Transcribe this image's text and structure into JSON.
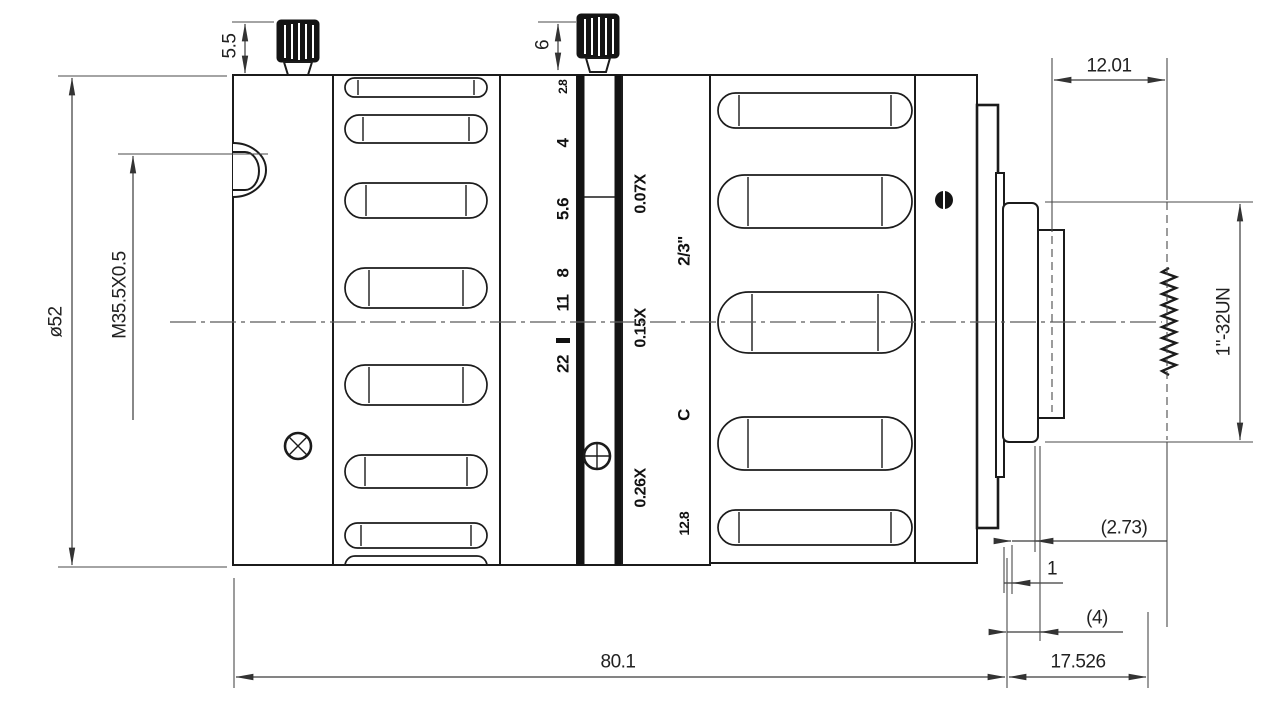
{
  "drawing": {
    "type": "lens-engineering-drawing",
    "dimensions": {
      "front_diameter": "ø52",
      "filter_thread": "M35.5X0.5",
      "front_knob_height": "5.5",
      "rear_knob_height": "6",
      "mount_section_length": "12.01",
      "mount_thread": "1\"-32UN",
      "flange_offset_ref": "(2.73)",
      "spacer": "1",
      "tip_ref": "(4)",
      "body_length": "80.1",
      "flange_focal_distance": "17.526"
    },
    "aperture_scale": {
      "values": [
        "2.8",
        "4",
        "5.6",
        "8",
        "11",
        "22"
      ]
    },
    "magnification_scale": {
      "values": [
        "0.07X",
        "0.15X",
        "0.26X"
      ]
    },
    "barrel_markings": {
      "sensor_format": "2/3\"",
      "mount_type": "C",
      "focal_length": "12.8",
      "index_mark": "Θ"
    }
  }
}
